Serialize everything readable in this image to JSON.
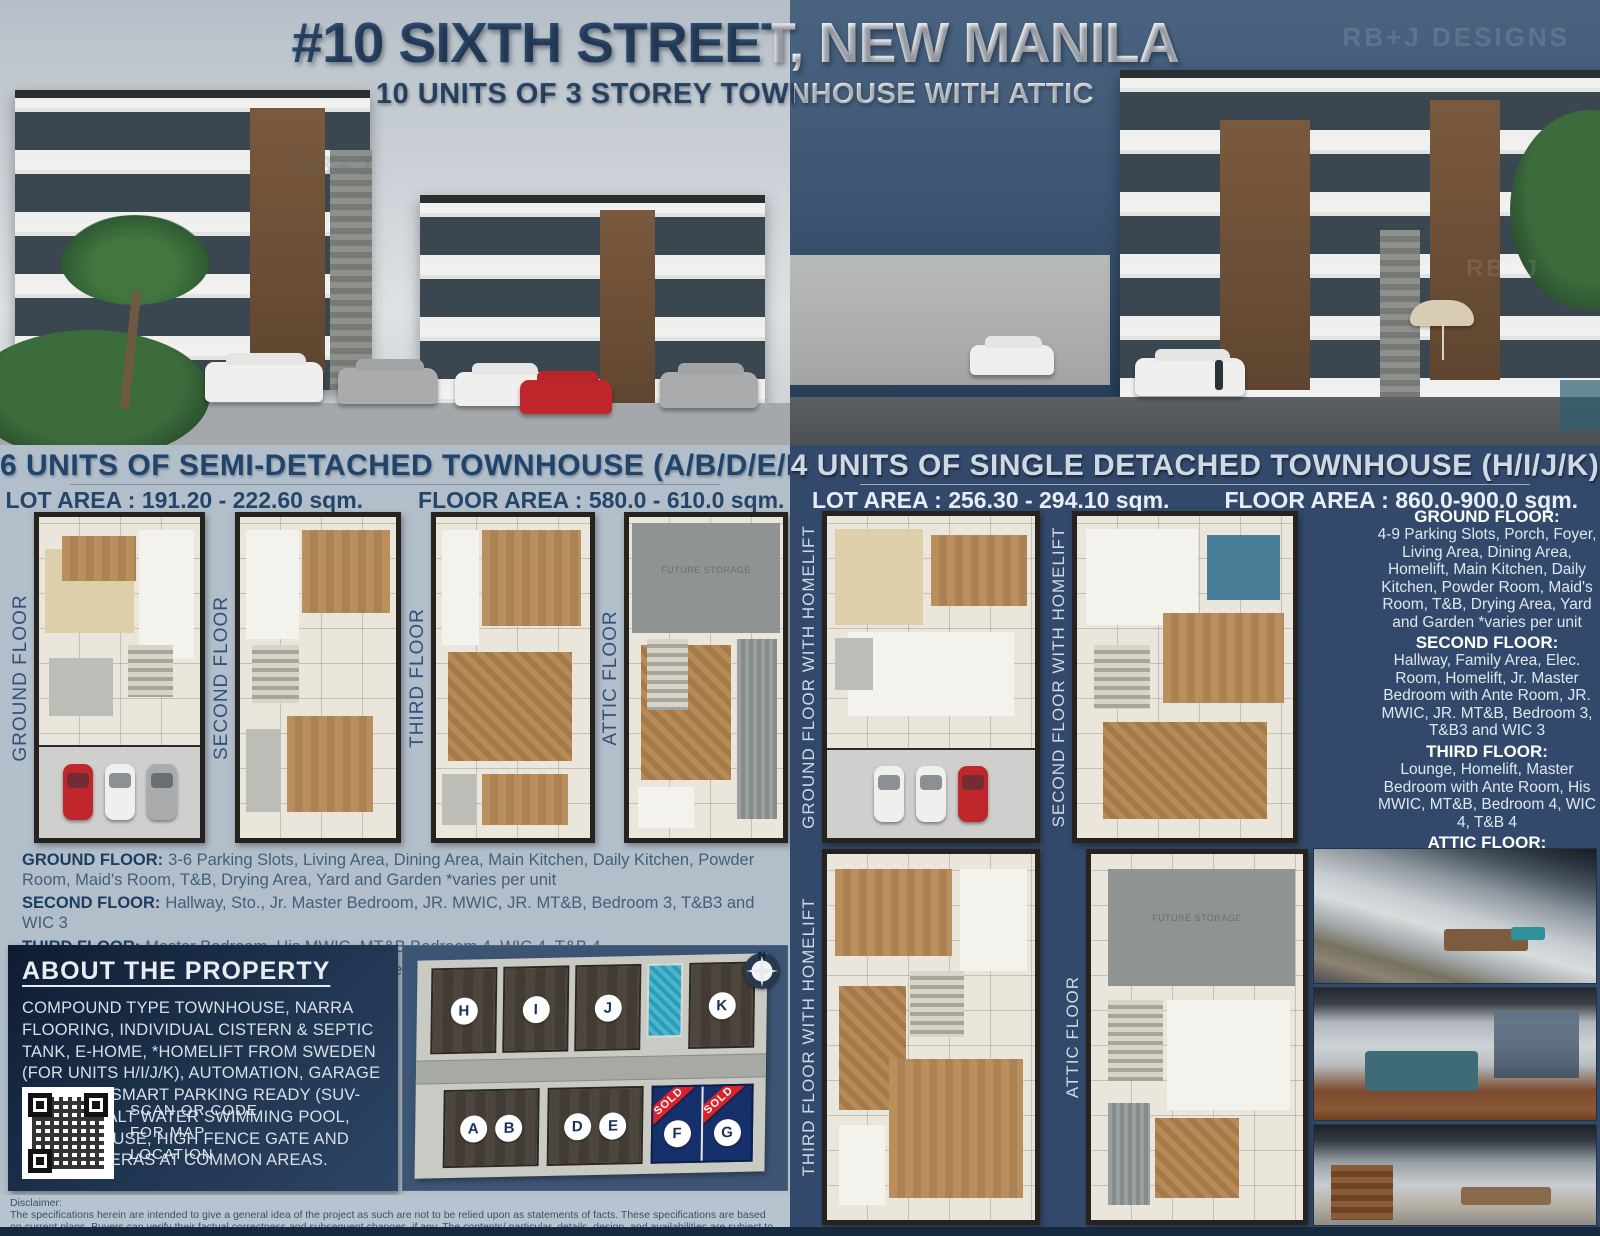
{
  "title": {
    "main": "#10 SIXTH STREET, NEW MANILA",
    "subtitle": "10 UNITS OF 3 STOREY TOWNHOUSE WITH ATTIC"
  },
  "watermarks": {
    "designs": "RB+J DESIGNS",
    "short": "RB+J"
  },
  "left": {
    "header": "6 UNITS OF SEMI-DETACHED TOWNHOUSE  (A/B/D/E/F/G)",
    "lot_area": "LOT AREA : 191.20 - 222.60 sqm.",
    "floor_area": "FLOOR AREA : 580.0 - 610.0 sqm.",
    "plan_labels": [
      "GROUND FLOOR",
      "SECOND FLOOR",
      "THIRD FLOOR",
      "ATTIC FLOOR"
    ],
    "future_storage": "FUTURE STORAGE",
    "floors": [
      {
        "name": "GROUND FLOOR:",
        "desc": "3-6 Parking Slots, Living Area, Dining Area, Main Kitchen, Daily Kitchen, Powder Room, Maid's Room, T&B, Drying Area, Yard and Garden *varies per unit"
      },
      {
        "name": "SECOND FLOOR:",
        "desc": "Hallway, Sto., Jr. Master Bedroom, JR. MWIC, JR. MT&B, Bedroom 3, T&B3 and WIC 3"
      },
      {
        "name": "THIRD FLOOR:",
        "desc": "Master Bedroom, His MWIC, MT&B,Bedroom 4, WIC 4, T&B 4"
      },
      {
        "name": "ATTIC FLOOR:",
        "desc": "Attic Hallway, Attic Storage 1&2,  Hers MWIC, and future storage provision"
      }
    ],
    "about": {
      "heading": "ABOUT THE PROPERTY",
      "body": "COMPOUND TYPE TOWNHOUSE, NARRA FLOORING, INDIVIDUAL CISTERN & SEPTIC TANK, E-HOME, *HOMELIFT FROM SWEDEN (FOR UNITS H/I/J/K), AUTOMATION, GARAGE HEIGHT IS SMART PARKING READY (SUV-SEDAN). SALT WATER SWIMMING POOL, GUARD HOUSE, HIGH FENCE GATE AND CCTV CAMERAS AT COMMON AREAS.",
      "qr_lines": [
        "SCAN QR CODE",
        "FOR MAP",
        "LOCATION"
      ]
    },
    "site_plan": {
      "top_units": [
        "H",
        "I",
        "J",
        "K"
      ],
      "bottom_units": [
        "A",
        "B",
        "D",
        "E",
        "F",
        "G"
      ],
      "sold_label": "SOLD",
      "compass_label": "N"
    }
  },
  "right": {
    "header": "4 UNITS OF SINGLE DETACHED TOWNHOUSE (H/I/J/K)",
    "lot_area": "LOT AREA : 256.30 - 294.10 sqm.",
    "floor_area": "FLOOR AREA : 860.0-900.0 sqm.",
    "plan_labels": [
      "GROUND FLOOR WITH HOMELIFT",
      "SECOND FLOOR WITH HOMELIFT",
      "THIRD FLOOR WITH HOMELIFT",
      "ATTIC FLOOR"
    ],
    "future_storage": "FUTURE STORAGE",
    "floors": [
      {
        "name": "GROUND FLOOR:",
        "desc": "4-9 Parking Slots, Porch, Foyer, Living Area, Dining Area, Homelift, Main Kitchen, Daily Kitchen, Powder Room, Maid's Room, T&B, Drying Area, Yard and Garden *varies per unit"
      },
      {
        "name": "SECOND FLOOR:",
        "desc": "Hallway, Family Area, Elec. Room, Homelift, Jr. Master Bedroom with Ante Room,  JR. MWIC, JR. MT&B, Bedroom 3, T&B3 and WIC 3"
      },
      {
        "name": "THIRD FLOOR:",
        "desc": "Lounge, Homelift, Master Bedroom with Ante Room, His MWIC, MT&B, Bedroom 4, WIC 4, T&B 4"
      },
      {
        "name": "ATTIC FLOOR:",
        "desc": "Attic Hallway, Attic Storage 1,  Hers MWIC, and future storage provision"
      }
    ]
  },
  "disclaimer": {
    "label": "Disclaimer:",
    "text": "The specifications herein are intended to give a general idea of the project as such are not to be relied upon as statements of facts. These specifications are based on current plans. Buyers can verify their factual correctness and subsequent changes, if any. The contents/ particular, details, design, and availabilities are subject to change without prior notice and do not constitute an offer o contract. For announcement purposes only."
  },
  "colors": {
    "title_navy": "#2f4e73",
    "left_bg": "#b2bfcb",
    "right_bg": "#33496b",
    "about_panel": "#16284a",
    "sold_red": "#d8232a",
    "sold_lot_navy": "#16306b",
    "pool_teal": "#2a9cb8",
    "disclaimer_bg": "#b7c3cf"
  }
}
